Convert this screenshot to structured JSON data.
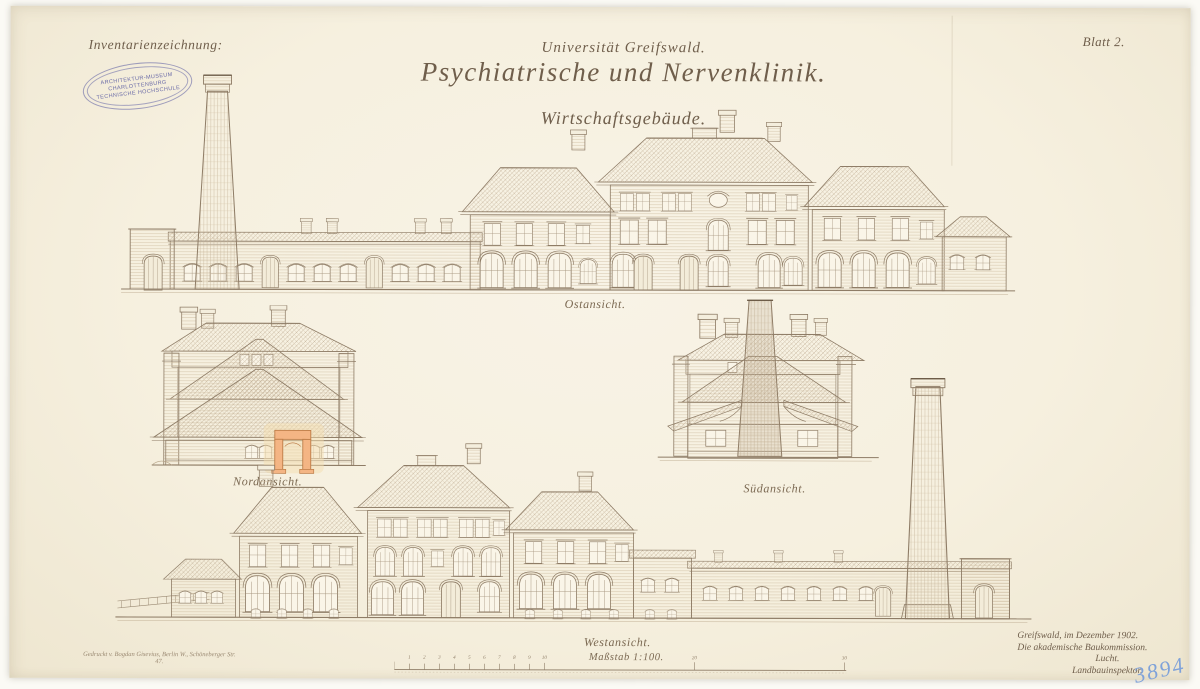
{
  "sheet": {
    "inventory_label": "Inventarienzeichnung:",
    "blatt_label": "Blatt 2.",
    "archive_number": "3894"
  },
  "title": {
    "university": "Universität Greifswald.",
    "main": "Psychiatrische und Nervenklinik.",
    "subtitle": "Wirtschaftsgebäude."
  },
  "stamp": {
    "line1": "ARCHITEKTUR-MUSEUM",
    "line2": "CHARLOTTENBURG",
    "line3": "TECHNISCHE HOCHSCHULE"
  },
  "views": {
    "east": {
      "caption": "Ostansicht."
    },
    "north": {
      "caption": "Nordansicht."
    },
    "south": {
      "caption": "Südansicht."
    },
    "west": {
      "caption": "Westansicht."
    }
  },
  "scale": {
    "label": "Maßstab 1:100.",
    "tick_labels": [
      "1",
      "2",
      "3",
      "4",
      "5",
      "6",
      "7",
      "8",
      "9",
      "10",
      "20",
      "30"
    ]
  },
  "footer": {
    "place_date": "Greifswald, im Dezember 1902.",
    "commission": "Die akademische Baukommission.",
    "signature": "Lucht.",
    "role": "Landbauinspektor.",
    "printer_line1": "Gedruckt v. Bogdan Gisevius, Berlin W., Schöneberger Str.",
    "printer_line2": "47."
  },
  "colors": {
    "paper": "#f7f2e3",
    "ink": "#8e7c66",
    "hatch": "#b9a78d",
    "stamp_blue": "#5557a1",
    "archive_blue": "#7fa2d9",
    "section_orange": "#f4b584"
  }
}
